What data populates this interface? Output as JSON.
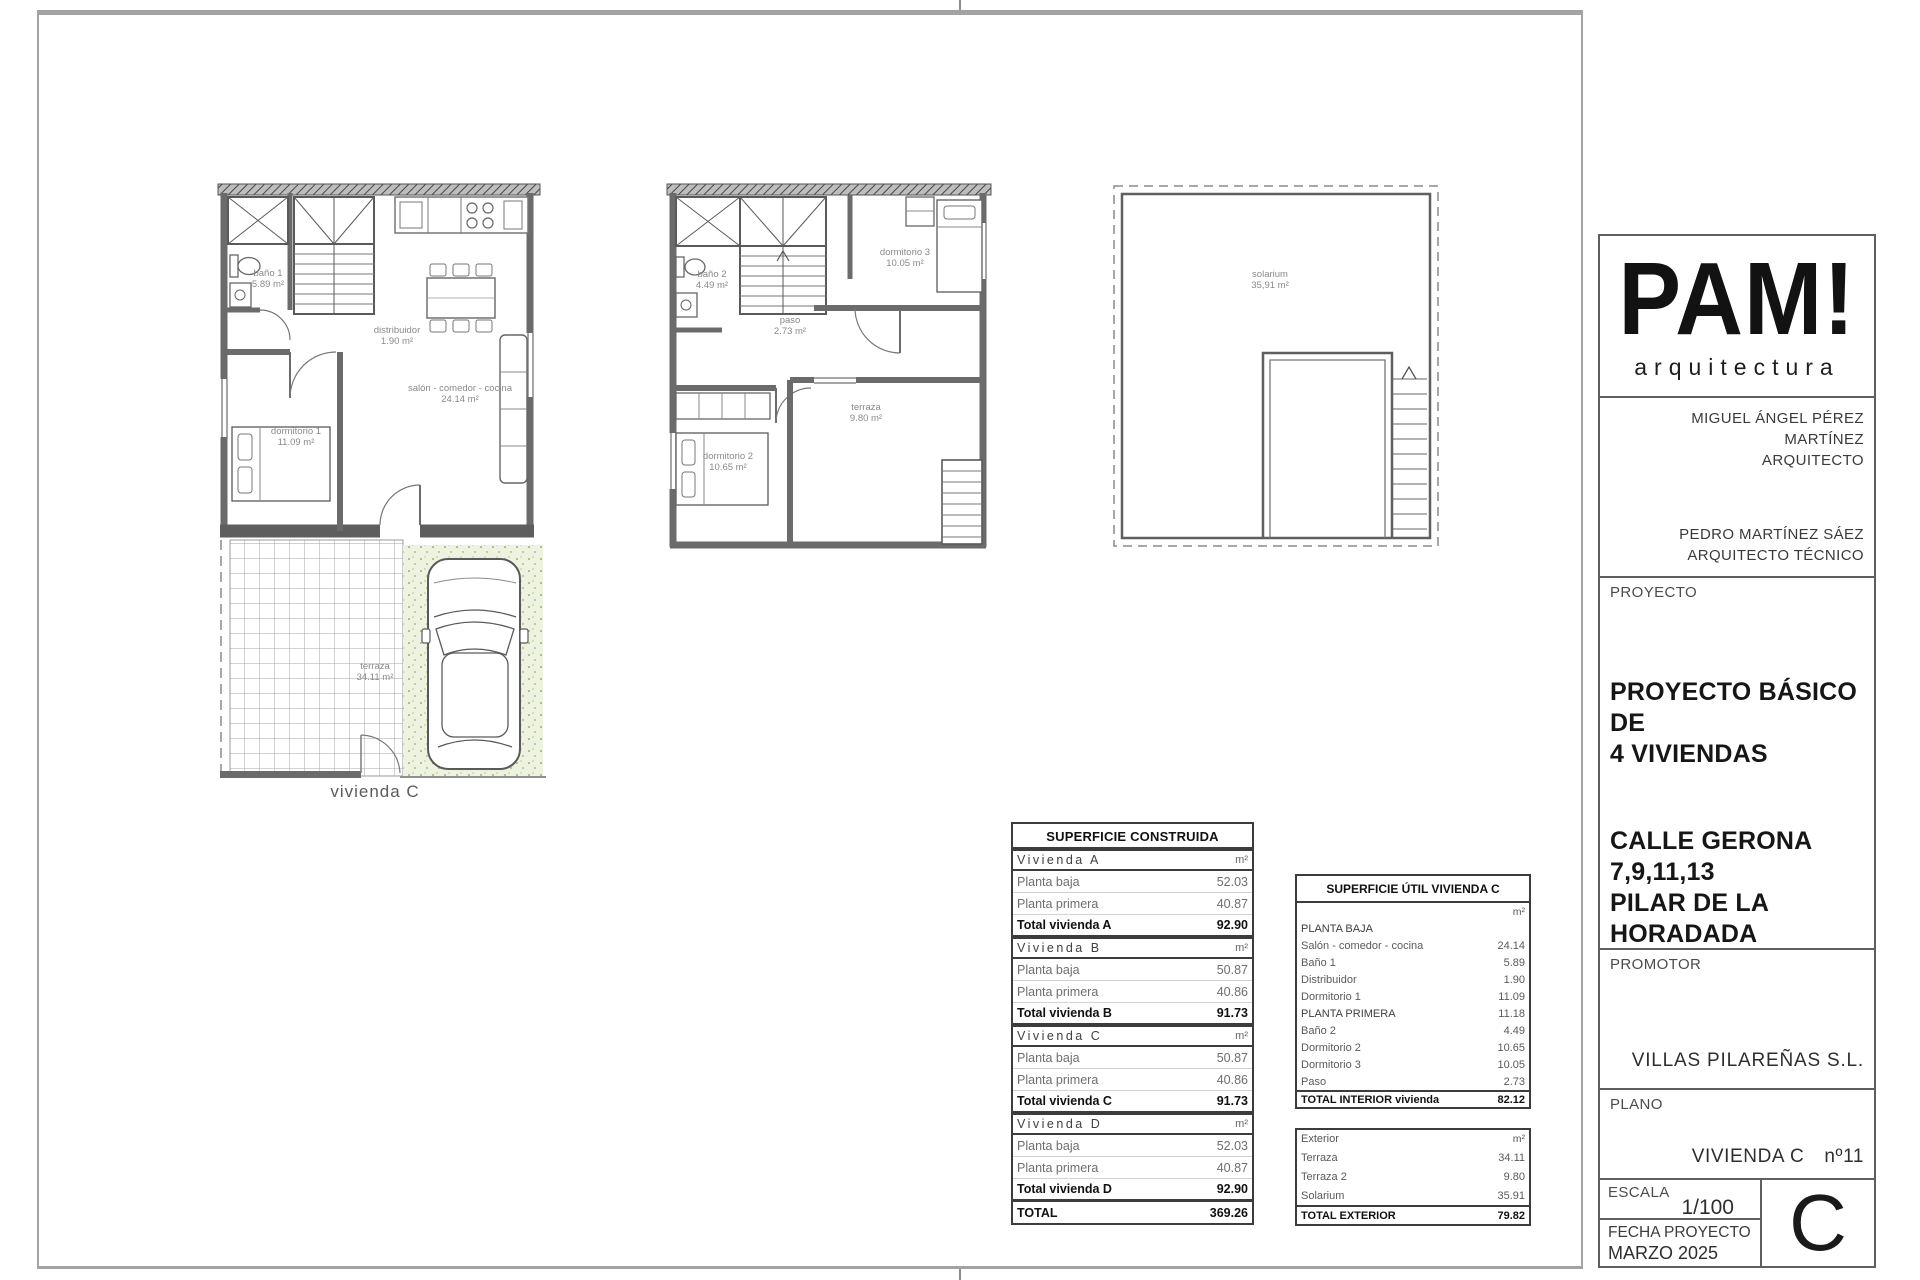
{
  "plans": {
    "ground_floor": {
      "caption": "vivienda C",
      "rooms": [
        {
          "name": "baño 1",
          "area": "5.89 m²"
        },
        {
          "name": "distribuidor",
          "area": "1.90 m²"
        },
        {
          "name": "salón - comedor - cocina",
          "area": "24.14 m²"
        },
        {
          "name": "dormitorio 1",
          "area": "11.09 m²"
        },
        {
          "name": "terraza",
          "area": "34.11 m²"
        }
      ]
    },
    "first_floor": {
      "rooms": [
        {
          "name": "baño 2",
          "area": "4.49 m²"
        },
        {
          "name": "paso",
          "area": "2.73 m²"
        },
        {
          "name": "dormitorio 3",
          "area": "10.05 m²"
        },
        {
          "name": "dormitorio 2",
          "area": "10.65 m²"
        },
        {
          "name": "terraza",
          "area": "9.80 m²"
        }
      ]
    },
    "solarium_floor": {
      "rooms": [
        {
          "name": "solarium",
          "area": "35,91 m²"
        }
      ]
    }
  },
  "tables": {
    "construida": {
      "title": "SUPERFICIE CONSTRUIDA",
      "rows": [
        {
          "type": "section",
          "label": "Vivienda A",
          "value": "m²"
        },
        {
          "type": "item",
          "label": "Planta baja",
          "value": "52.03"
        },
        {
          "type": "item",
          "label": "Planta primera",
          "value": "40.87"
        },
        {
          "type": "total",
          "label": "Total vivienda A",
          "value": "92.90"
        },
        {
          "type": "section",
          "label": "Vivienda B",
          "value": "m²"
        },
        {
          "type": "item",
          "label": "Planta baja",
          "value": "50.87"
        },
        {
          "type": "item",
          "label": "Planta primera",
          "value": "40.86"
        },
        {
          "type": "total",
          "label": "Total vivienda B",
          "value": "91.73"
        },
        {
          "type": "section",
          "label": "Vivienda C",
          "value": "m²"
        },
        {
          "type": "item",
          "label": "Planta baja",
          "value": "50.87"
        },
        {
          "type": "item",
          "label": "Planta primera",
          "value": "40.86"
        },
        {
          "type": "total",
          "label": "Total vivienda C",
          "value": "91.73"
        },
        {
          "type": "section",
          "label": "Vivienda D",
          "value": "m²"
        },
        {
          "type": "item",
          "label": "Planta baja",
          "value": "52.03"
        },
        {
          "type": "item",
          "label": "Planta primera",
          "value": "40.87"
        },
        {
          "type": "total",
          "label": "Total vivienda D",
          "value": "92.90"
        },
        {
          "type": "grand",
          "label": "TOTAL",
          "value": "369.26"
        }
      ]
    },
    "util": {
      "title": "SUPERFICIE ÚTIL VIVIENDA C",
      "interior_rows": [
        {
          "type": "unit",
          "label": "",
          "value": "m²"
        },
        {
          "type": "section",
          "label": "PLANTA BAJA",
          "value": ""
        },
        {
          "type": "item",
          "label": "Salón - comedor - cocina",
          "value": "24.14"
        },
        {
          "type": "item",
          "label": "Baño 1",
          "value": "5.89"
        },
        {
          "type": "item",
          "label": "Distribuidor",
          "value": "1.90"
        },
        {
          "type": "item",
          "label": "Dormitorio 1",
          "value": "11.09"
        },
        {
          "type": "section",
          "label": "PLANTA PRIMERA",
          "value": "11.18"
        },
        {
          "type": "item",
          "label": "Baño 2",
          "value": "4.49"
        },
        {
          "type": "item",
          "label": "Dormitorio 2",
          "value": "10.65"
        },
        {
          "type": "item",
          "label": "Dormitorio 3",
          "value": "10.05"
        },
        {
          "type": "item",
          "label": "Paso",
          "value": "2.73"
        },
        {
          "type": "grand",
          "label": "TOTAL INTERIOR vivienda",
          "value": "82.12"
        }
      ],
      "exterior_rows": [
        {
          "type": "unit",
          "label": "Exterior",
          "value": "m²"
        },
        {
          "type": "item",
          "label": "Terraza",
          "value": "34.11"
        },
        {
          "type": "item",
          "label": "Terraza 2",
          "value": "9.80"
        },
        {
          "type": "item",
          "label": "Solarium",
          "value": "35.91"
        },
        {
          "type": "grand",
          "label": "TOTAL EXTERIOR",
          "value": "79.82"
        }
      ]
    }
  },
  "title_block": {
    "logo": {
      "name": "PAM!",
      "subtitle": "arquitectura"
    },
    "architects": {
      "architect_name": "MIGUEL ÁNGEL PÉREZ MARTÍNEZ",
      "architect_role": "ARQUITECTO",
      "technical_name": "PEDRO MARTÍNEZ SÁEZ",
      "technical_role": "ARQUITECTO TÉCNICO"
    },
    "proyecto": {
      "label": "PROYECTO",
      "title_line1": "PROYECTO BÁSICO DE",
      "title_line2": "4 VIVIENDAS",
      "address_line1": "CALLE GERONA",
      "address_line2": "7,9,11,13",
      "address_line3": "PILAR DE LA HORADADA",
      "address_line4": "(ALICANTE)"
    },
    "promotor": {
      "label": "PROMOTOR",
      "name": "VILLAS PILAREÑAS S.L."
    },
    "plano": {
      "label": "PLANO",
      "name": "VIVIENDA C",
      "number": "nº11"
    },
    "escala": {
      "label": "ESCALA",
      "value": "1/100"
    },
    "fecha": {
      "label": "FECHA PROYECTO",
      "value": "MARZO 2025"
    },
    "sheet_letter": "C"
  }
}
